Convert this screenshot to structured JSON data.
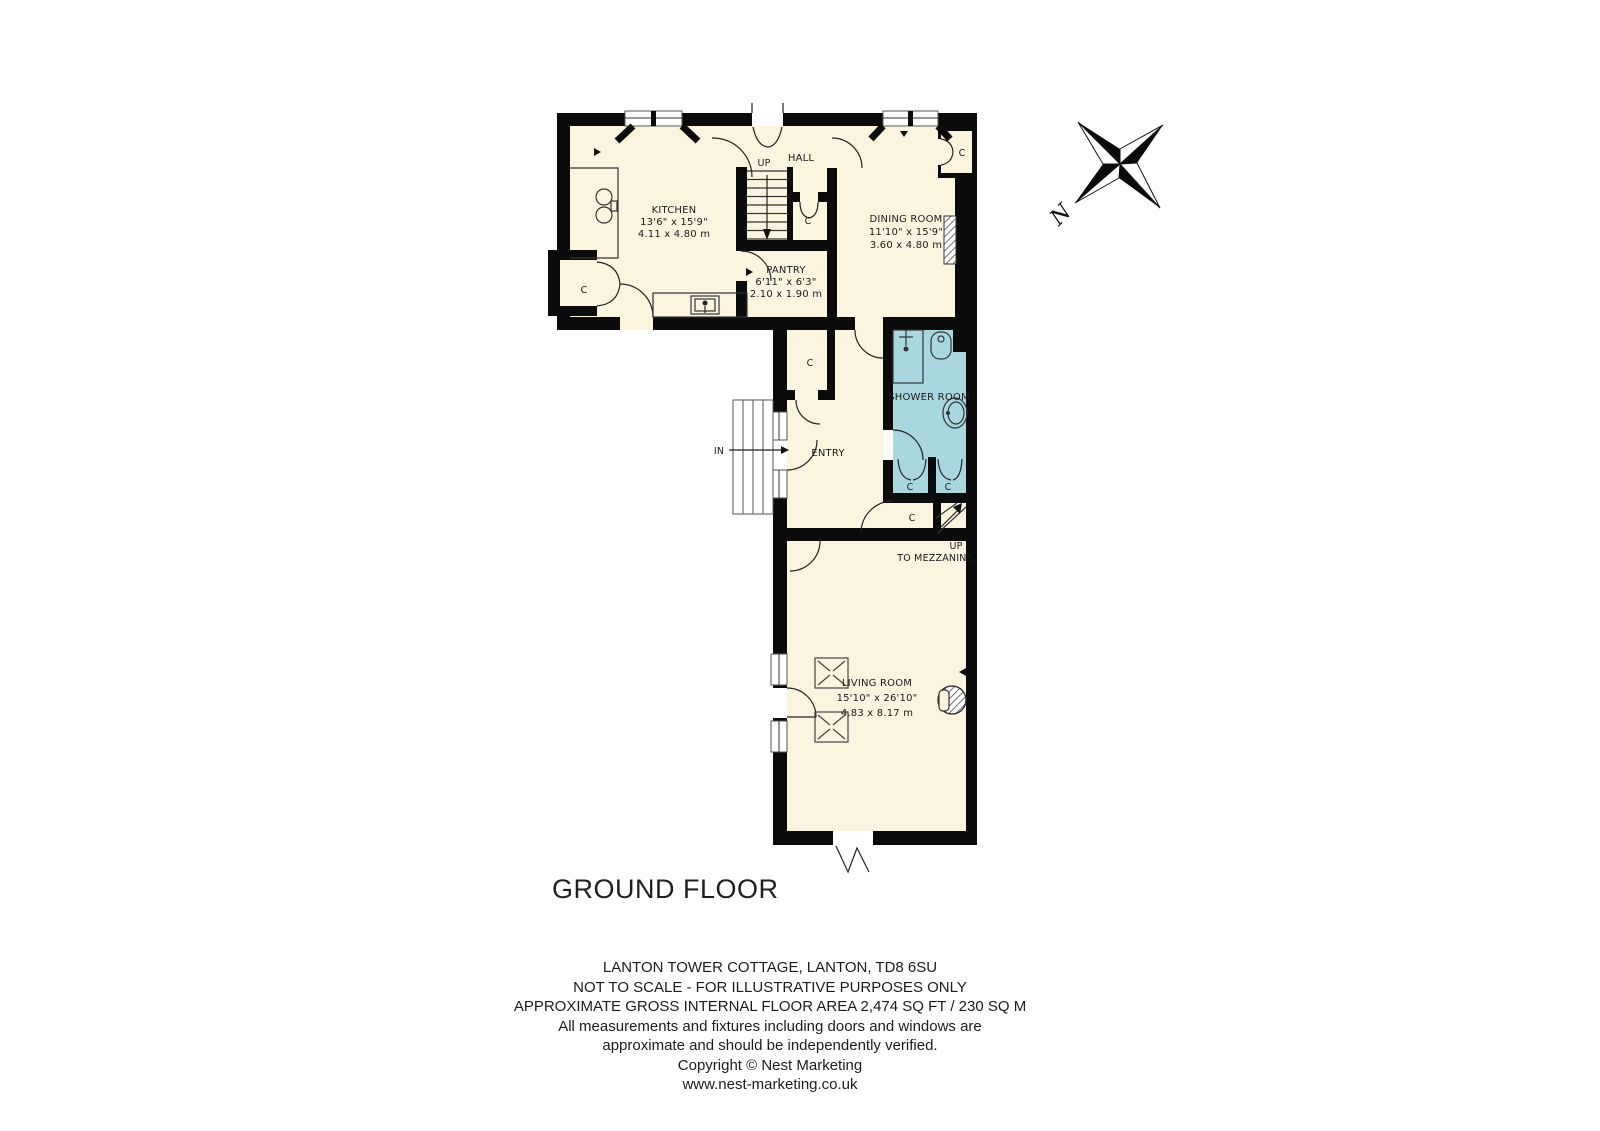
{
  "title": "GROUND FLOOR",
  "compass": {
    "north": "N"
  },
  "labels": {
    "closet": "C",
    "up": "UP",
    "in": "IN",
    "hall": "HALL",
    "entry": "ENTRY",
    "shower_room": "SHOWER ROOM",
    "mezzanine_line1": "UP",
    "mezzanine_line2": "TO MEZZANINE"
  },
  "rooms": {
    "kitchen": {
      "name": "KITCHEN",
      "imperial": "13'6\" x 15'9\"",
      "metric": "4.11 x 4.80 m"
    },
    "dining": {
      "name": "DINING ROOM",
      "imperial": "11'10\" x 15'9\"",
      "metric": "3.60 x 4.80 m"
    },
    "pantry": {
      "name": "PANTRY",
      "imperial": "6'11\" x 6'3\"",
      "metric": "2.10 x 1.90 m"
    },
    "living": {
      "name": "LIVING ROOM",
      "imperial": "15'10\" x 26'10\"",
      "metric": "4.83 x 8.17 m"
    }
  },
  "footer": {
    "lines": [
      "LANTON TOWER COTTAGE, LANTON, TD8 6SU",
      "NOT TO SCALE - FOR ILLUSTRATIVE PURPOSES ONLY",
      "APPROXIMATE GROSS INTERNAL FLOOR AREA 2,474 SQ FT / 230 SQ M",
      "All measurements and fixtures including doors and windows are",
      "approximate and should be independently verified.",
      "Copyright © Nest Marketing",
      "www.nest-marketing.co.uk"
    ]
  },
  "colors": {
    "floor": "#FBF5E0",
    "wet_room": "#A9D7E0",
    "wall": "#0B0B0B"
  }
}
